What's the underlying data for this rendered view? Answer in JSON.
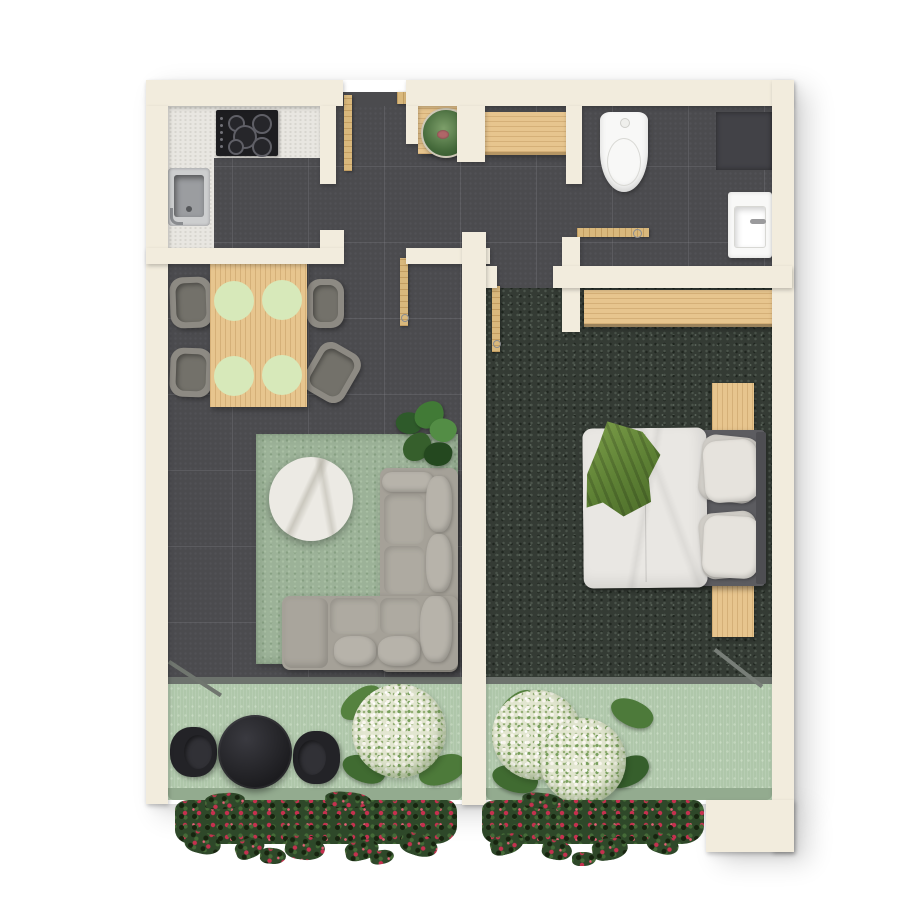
{
  "scene": {
    "kind": "apartment-floor-plan",
    "view": "top-down-render",
    "contains_text": false
  },
  "palette": {
    "background": "#ffffff",
    "wall": "#f2ecdd",
    "floor_tile": "#4b4b4e",
    "bedroom_carpet": "#343b34",
    "area_rug": "#9cb298",
    "balcony_floor": "#afc7aa",
    "balcony_edge": "#93ab8f",
    "threshold": "#6d736d",
    "wood": "#e7c58e",
    "door_wood": "#d9b87c",
    "counter": "#e8e6e1",
    "cooktop": "#1d1d20",
    "fixture_white": "#f8f8f7",
    "sofa_shell": "#a5a198",
    "sofa_cushion": "#b7b3aa",
    "marble": "#eceae4",
    "chair_gray": "#8d8a83",
    "placemat_green": "#d7e9ba",
    "throw_green": "#6f9140",
    "bistro_black": "#232327",
    "foliage_dark": "#2e4829",
    "flower_red": "#c5314f",
    "flower_white": "#f3efe3",
    "plant_green": "#417a36"
  },
  "rooms": [
    {
      "name": "kitchen"
    },
    {
      "name": "hallway"
    },
    {
      "name": "bathroom"
    },
    {
      "name": "living-dining-room"
    },
    {
      "name": "bedroom"
    },
    {
      "name": "balcony-left"
    },
    {
      "name": "balcony-right"
    }
  ],
  "fixtures": [
    "entrance-door",
    "kitchen-counter",
    "cooktop",
    "kitchen-sink",
    "toilet",
    "washbasin",
    "shower-area",
    "built-in-wardrobe",
    "interior-doors",
    "sliding-balcony-doors"
  ],
  "furniture": [
    "dining-table",
    "dining-chairs",
    "placemats",
    "area-rug",
    "round-coffee-table",
    "corner-sofa",
    "monstera-plant",
    "hall-bench",
    "potted-succulent",
    "double-bed",
    "pillows",
    "duvet",
    "green-throw-blanket",
    "nightstands",
    "bistro-table",
    "bistro-chairs",
    "white-flowering-shrubs",
    "red-window-box-flowers"
  ]
}
